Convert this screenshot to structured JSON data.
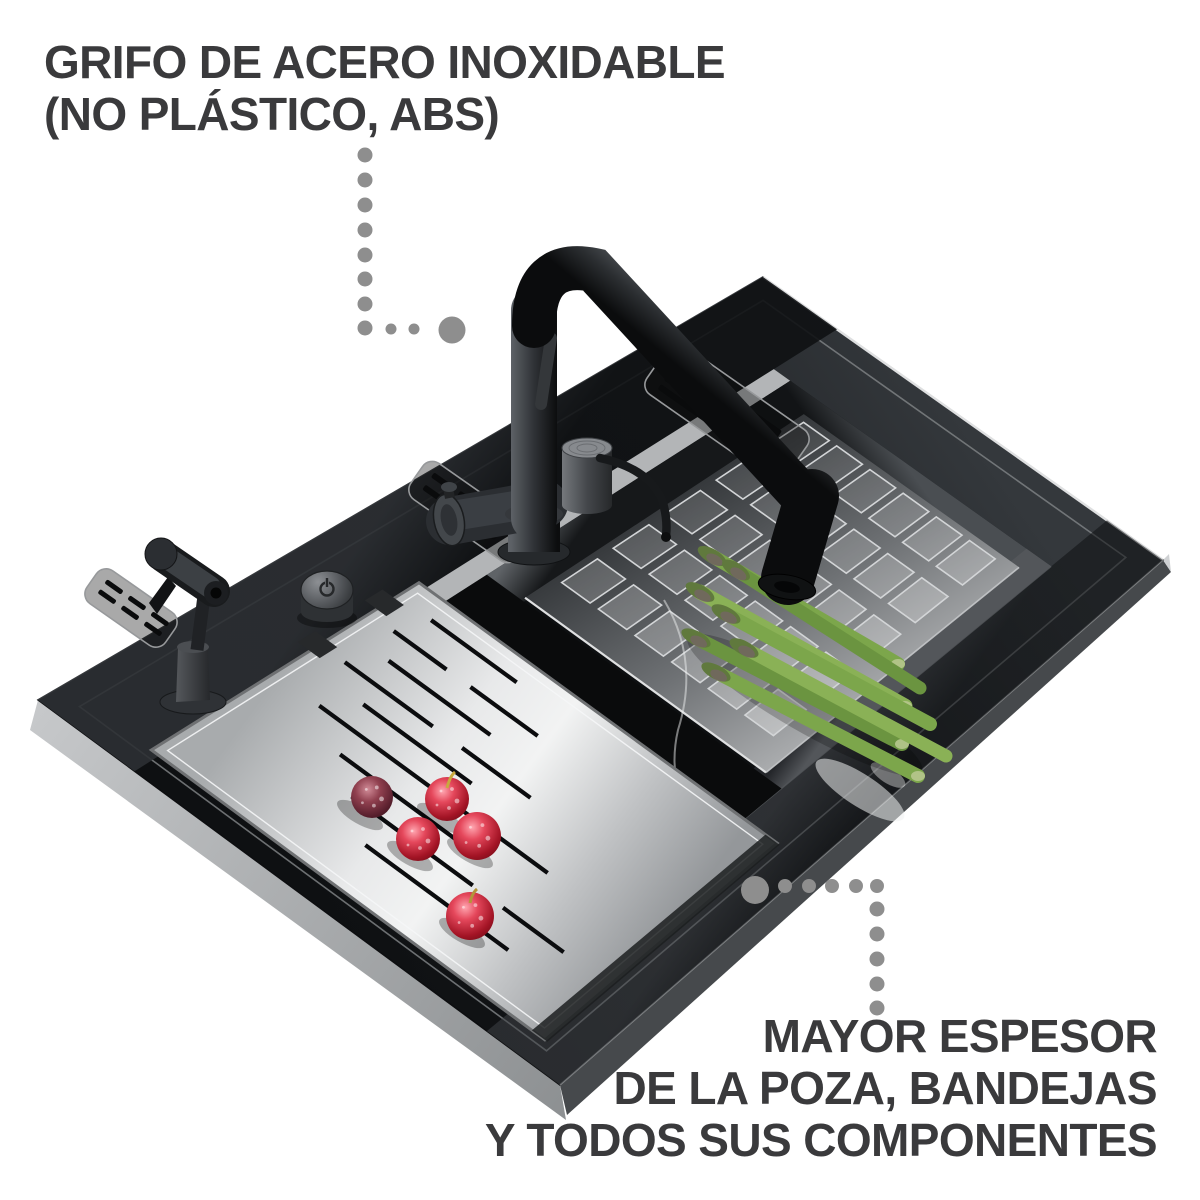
{
  "annotations": {
    "faucet_material": {
      "lines": [
        "GRIFO DE ACERO INOXIDABLE",
        "(NO PLÁSTICO, ABS)"
      ]
    },
    "thickness": {
      "lines": [
        "MAYOR ESPESOR",
        "DE LA POZA, BANDEJAS",
        "Y TODOS SUS COMPONENTES"
      ]
    }
  },
  "icons": {
    "touch_button": "power-icon",
    "leader_top": "dotted-leader-line",
    "leader_bottom": "dotted-leader-line"
  },
  "colors": {
    "text": "#3a3a3c",
    "dots": "#8e8e8e",
    "sink_black": "#17191b",
    "steel_light": "#d8dadb",
    "steel_mid": "#aeb0b2",
    "berry_red": "#b81f33",
    "berry_dark": "#5f2334",
    "asparagus_green": "#7aa449"
  }
}
